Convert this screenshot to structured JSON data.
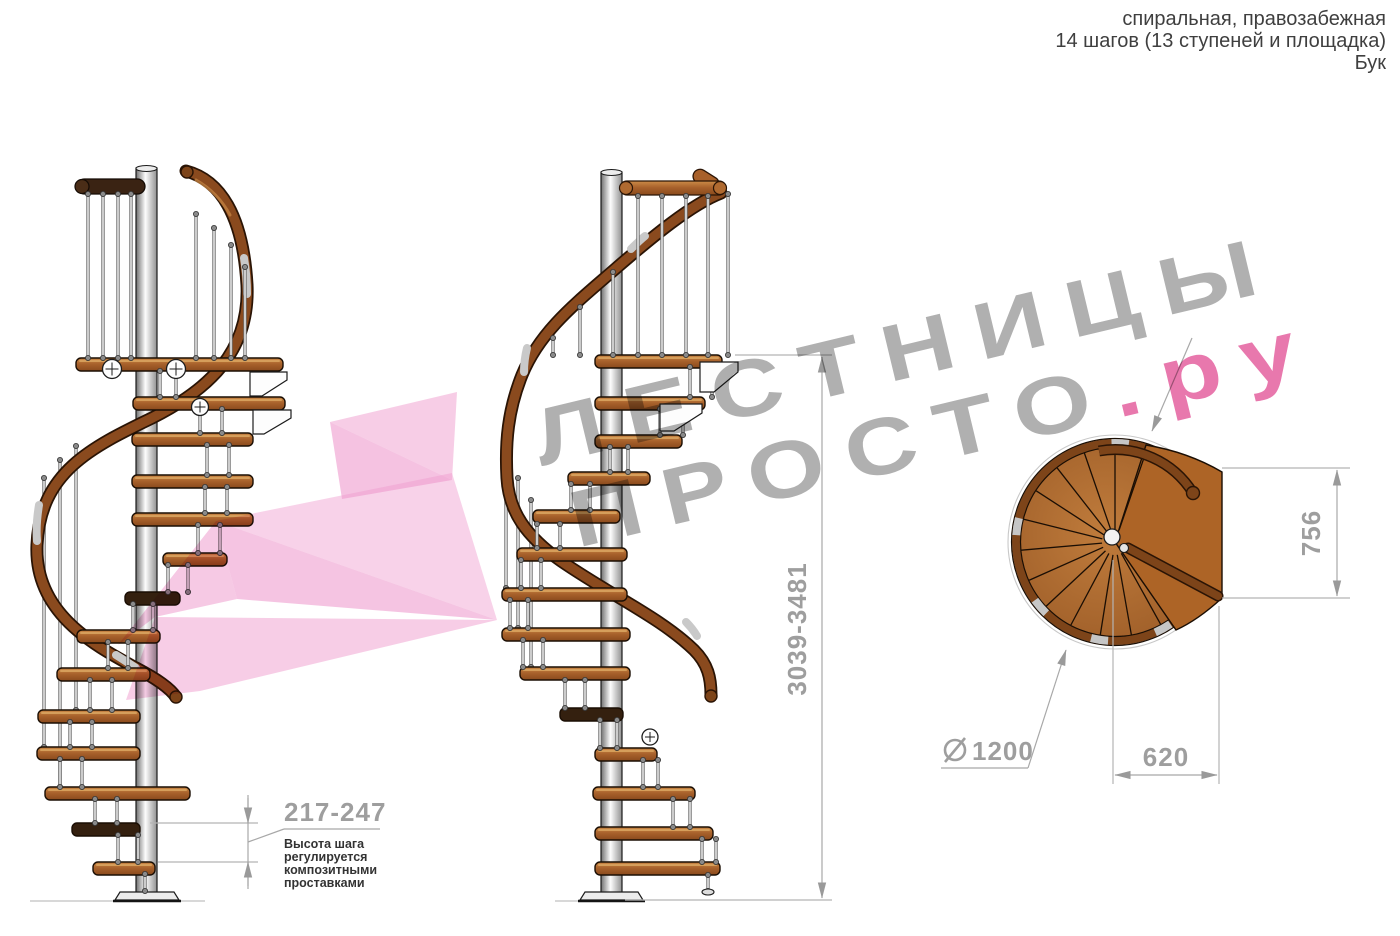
{
  "header": {
    "line1": "спиральная, правозабежная",
    "line2": "14 шагов (13 ступеней и площадка)",
    "line3": "Бук"
  },
  "watermark": {
    "line1": "ЛЕСТНИЦЫ",
    "line2_gray": "ПРОСТО",
    "line2_pink": ".ру",
    "gray_color": "#b0b0b0",
    "pink_color": "#e878ad",
    "arrow_color": "#ef9cce"
  },
  "dimensions": {
    "total_height": "3039-3481",
    "step_height": "217-247",
    "step_note": [
      "Высота шага",
      "регулируется",
      "композитными",
      "проставками"
    ],
    "landing_width": "756",
    "landing_depth": "620",
    "diameter_symbol": "⌀",
    "diameter_value": "1200",
    "dim_color": "#9e9e9e",
    "note_color": "#333333"
  },
  "drawing": {
    "wood_color": "#a9622c",
    "dark_wood_color": "#34200f",
    "rail_color": "#8a4a1e",
    "pole_color": "#d9d9d9"
  }
}
